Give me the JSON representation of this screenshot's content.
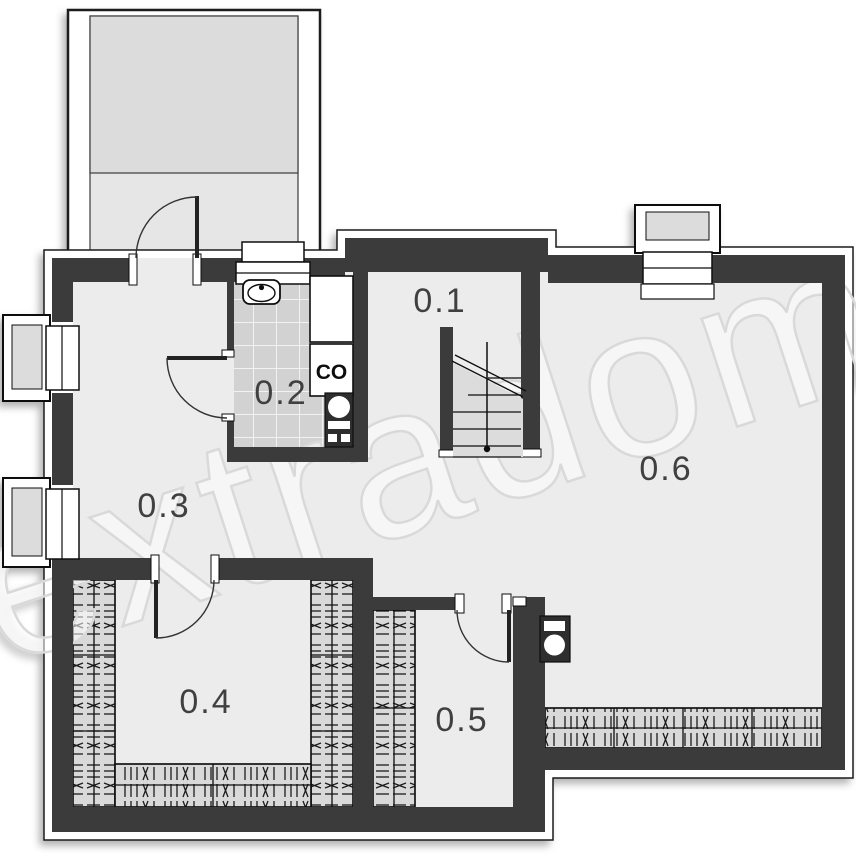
{
  "watermark": "extradom",
  "boiler_unit_label": "CO",
  "rooms": [
    {
      "label": "0.1"
    },
    {
      "label": "0.2"
    },
    {
      "label": "0.3"
    },
    {
      "label": "0.4"
    },
    {
      "label": "0.5"
    },
    {
      "label": "0.6"
    }
  ],
  "colors": {
    "wall": "#3a3a3a",
    "floor": "#ececec",
    "terrace_floor": "#dcdcdc",
    "tile": "#d2d2d2",
    "insulation_band": "#d9d9d9",
    "stair_fill": "#dcdcdc",
    "label_text": "#3f3f3f",
    "watermark_stroke": "#d9d9d9"
  }
}
